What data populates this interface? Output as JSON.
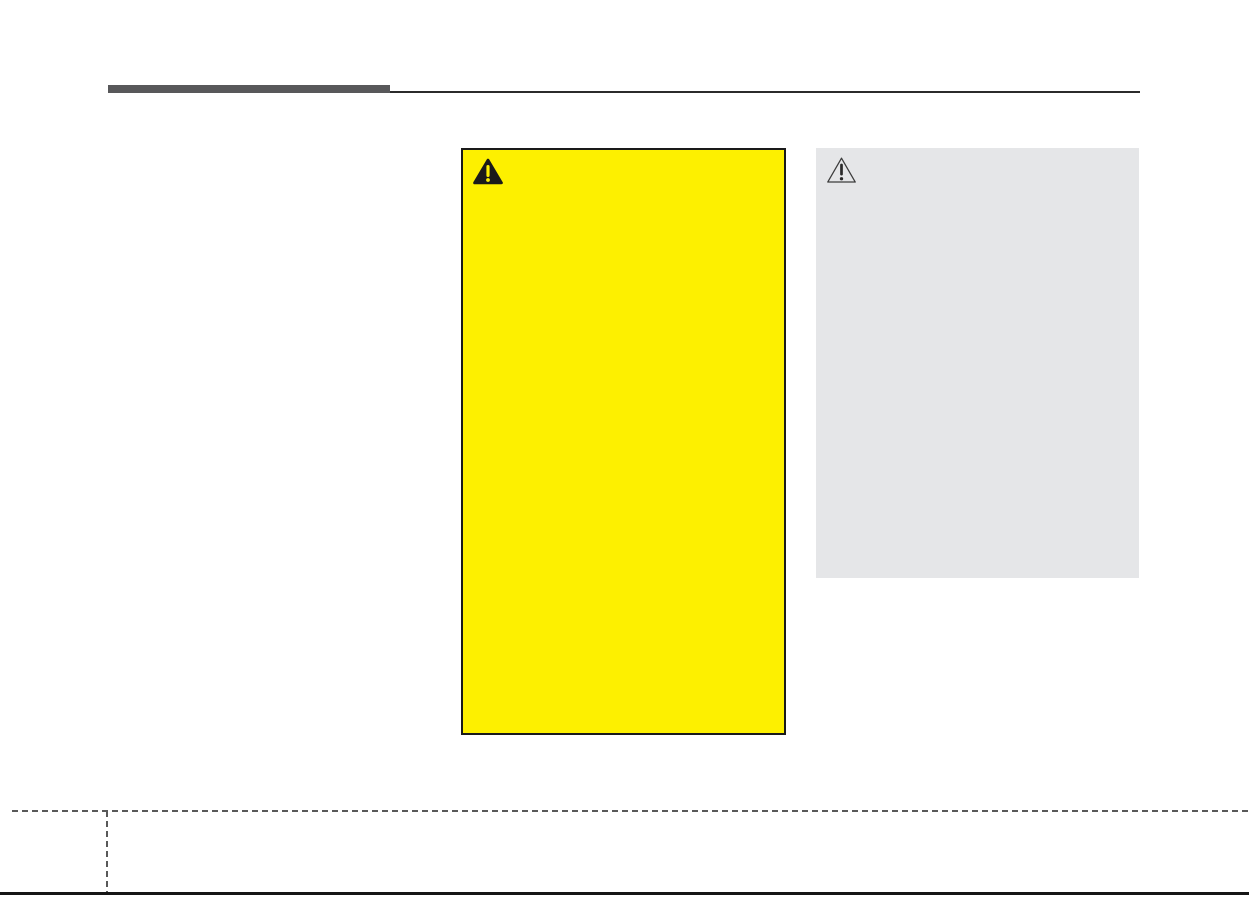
{
  "page": {
    "background_color": "#ffffff"
  },
  "header": {
    "bar_color": "#58585a",
    "rule_color": "#2b2b2b"
  },
  "warning_box": {
    "background_color": "#fdf000",
    "border_color": "#1a1a1a",
    "icon": "warning-triangle-filled-icon",
    "icon_triangle_color": "#1a1a1a",
    "icon_exclamation_color": "#fdf000"
  },
  "caution_box": {
    "background_color": "#e5e6e8",
    "icon": "warning-triangle-outline-icon",
    "icon_outline_color": "#3c3c3c",
    "icon_exclamation_color": "#2a2a2a"
  },
  "footer_marks": {
    "dashed_line_color": "#595959",
    "bottom_edge_color": "#161616"
  }
}
